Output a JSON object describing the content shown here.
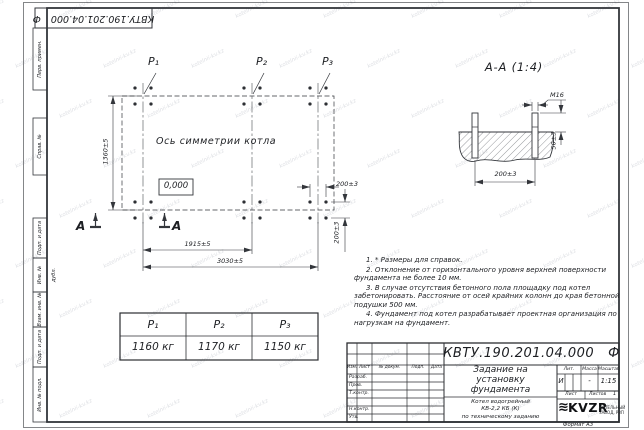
{
  "sheet": {
    "format_label": "Формат А3",
    "watermark": "kotelnii-kv.kz"
  },
  "margins": {
    "top_designation": "КВТУ.190.201.04.000",
    "top_designation_suffix": "Ф",
    "left_labels": [
      "Перв. примен.",
      "Справ. №",
      "Подп. и дата",
      "Инв. № дубл.",
      "Взам. инв. №",
      "Подп. и дата",
      "Инв. № подл."
    ]
  },
  "plan": {
    "points": [
      "P₁",
      "P₂",
      "P₃"
    ],
    "axis_label": "Ось симметрии котла",
    "level_mark": "0,000",
    "section_letter": "А",
    "dims": {
      "height": "1360±5",
      "span_p1_p2": "1915±5",
      "span_total": "3030±5",
      "bolt_pitch_x": "200±3",
      "bolt_pitch_y": "200±3"
    }
  },
  "section_view": {
    "title": "А-А (1:4)",
    "thread_label": "М16",
    "dims": {
      "protrusion": "50±3",
      "bolt_pitch": "200±3"
    }
  },
  "loads_table": {
    "headers": [
      "P₁",
      "P₂",
      "P₃"
    ],
    "values": [
      "1160 кг",
      "1170 кг",
      "1150 кг"
    ]
  },
  "notes": [
    "1. * Размеры для справок.",
    "2. Отклонение от горизонтального уровня верхней поверхности фундамента не более 10 мм.",
    "3. В случае отсутствия бетонного пола площадку под котел забетонировать. Расстояние от осей крайних колонн до края бетонной подушки 500 мм.",
    "4. Фундамент под котел разрабатывает проектная организация по нагрузкам на фундамент."
  ],
  "title_block": {
    "designation": "КВТУ.190.201.04.000",
    "designation_suffix": "Ф",
    "doc_title_lines": [
      "Задание на",
      "установку",
      "фундамента"
    ],
    "product_lines": [
      "Котел водогрейный",
      "КВ-2,2 КБ (К)",
      "по техническому заданию"
    ],
    "rev_columns": [
      "Изм.",
      "Лист",
      "№ докум.",
      "Подп.",
      "Дата"
    ],
    "roles": [
      "Разраб.",
      "Пров.",
      "Т.контр.",
      "Н.контр.",
      "Утв."
    ],
    "lit_label": "Лит.",
    "lit_value": "И",
    "mass_label": "Масса",
    "mass_value": "-",
    "scale_label": "Масштаб",
    "scale_value": "1:15",
    "sheet_label": "Лист",
    "sheets_label": "Листов",
    "sheets_value": "1",
    "logo_text": "KVZR",
    "company_lines": [
      "КОТЕЛЬНЫЙ",
      "ЗАВОД, РЗП"
    ]
  }
}
